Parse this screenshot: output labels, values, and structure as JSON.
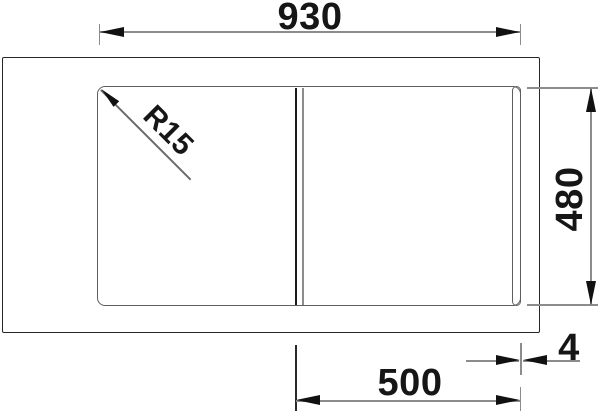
{
  "drawing": {
    "dimensions": {
      "overall_width_mm": "930",
      "overall_depth_mm": "480",
      "bowl_width_mm": "500",
      "offset_mm": "4",
      "corner_radius": "R15"
    },
    "colors": {
      "line_primary": "#1a1a1a",
      "line_secondary": "#8c8c8c",
      "outline_dark": "#262626",
      "outline_mid": "#5e5e5e",
      "background": "#ffffff"
    }
  }
}
